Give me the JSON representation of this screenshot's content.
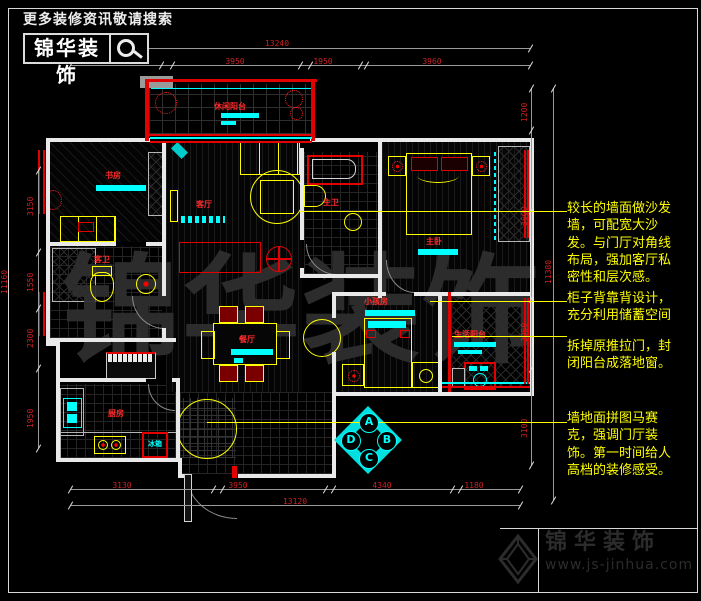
{
  "header": {
    "tagline": "更多装修资讯敬请搜索",
    "brand": "锦华装饰"
  },
  "footer": {
    "brand": "锦华装饰",
    "url": "www.js-jinhua.com"
  },
  "watermark_text": "锦华装饰",
  "annotations": [
    {
      "text": "较长的墙面做沙发墙，可配宽大沙发。与门厅对角线布局，强加客厅私密性和层次感。"
    },
    {
      "text": "柜子背靠背设计，充分利用储蓄空间"
    },
    {
      "text": "拆掉原推拉门，封闭阳台成落地窗。"
    },
    {
      "text": "墙地面拼图马赛克，强调门厅装饰。第一时间给人高档的装修感受。"
    }
  ],
  "rooms": {
    "leisure_balcony": "休闲阳台",
    "study": "书房",
    "guest_bath": "客卫",
    "kitchen": "厨房",
    "fridge": "冰箱",
    "living": "客厅",
    "dining": "餐厅",
    "master_bath": "主卫",
    "master_bedroom": "主卧",
    "kids_room": "小孩房",
    "service_balcony": "生活阳台"
  },
  "compass": {
    "a": "A",
    "b": "B",
    "c": "C",
    "d": "D"
  },
  "dimensions": {
    "top_total": "13240",
    "top_segments": [
      "3050",
      "3950",
      "1950",
      "3960"
    ],
    "bottom_total": "13120",
    "bottom_segments": [
      "3130",
      "3950",
      "4340",
      "1180"
    ],
    "left_total": "11160",
    "left_segments": [
      "3150",
      "1550",
      "2300",
      "1950"
    ],
    "right_total": "11380",
    "right_segments": [
      "1200",
      "3600",
      "2950",
      "3100"
    ]
  },
  "colors": {
    "annotation": "#ffff00",
    "dimension": "#cc2222",
    "room_label": "#ff2a2a",
    "window": "#00ffff",
    "wall": "#e9e9e9",
    "accent": "#ff0000"
  }
}
